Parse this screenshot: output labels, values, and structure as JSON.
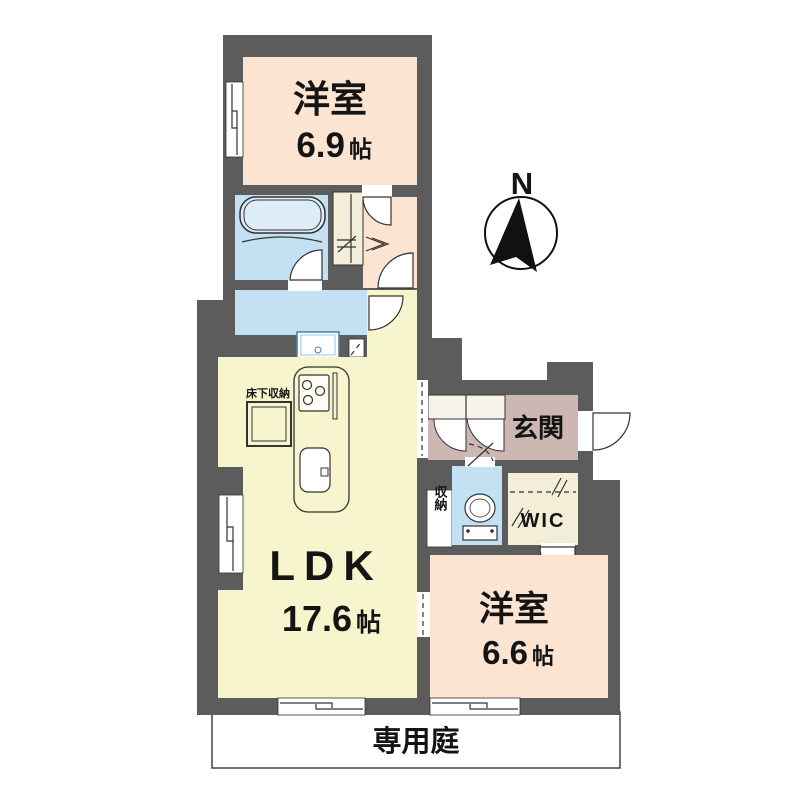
{
  "page": {
    "background": "#ffffff"
  },
  "colors": {
    "wall": "#5d5c5c",
    "bedroom": "#fce4d2",
    "ldk": "#f7f5cd",
    "closet": "#f3eed8",
    "water": "#c3e1f3",
    "tub": "#dcedf8",
    "entrance": "#cdb7b2",
    "storage_white": "#ffffff",
    "outline": "#333333"
  },
  "rooms": {
    "bedroom_top": {
      "name": "洋室",
      "size_value": "6.9",
      "size_unit": "帖"
    },
    "ldk": {
      "name": "LDK",
      "size_value": "17.6",
      "size_unit": "帖"
    },
    "bedroom_right": {
      "name": "洋室",
      "size_value": "6.6",
      "size_unit": "帖"
    },
    "entrance": {
      "name": "玄関"
    },
    "wic": {
      "name": "WIC"
    },
    "storage": {
      "name": "収納"
    },
    "underfloor_storage": {
      "name": "床下収納"
    },
    "garden": {
      "name": "専用庭"
    }
  },
  "compass": {
    "label": "N"
  }
}
